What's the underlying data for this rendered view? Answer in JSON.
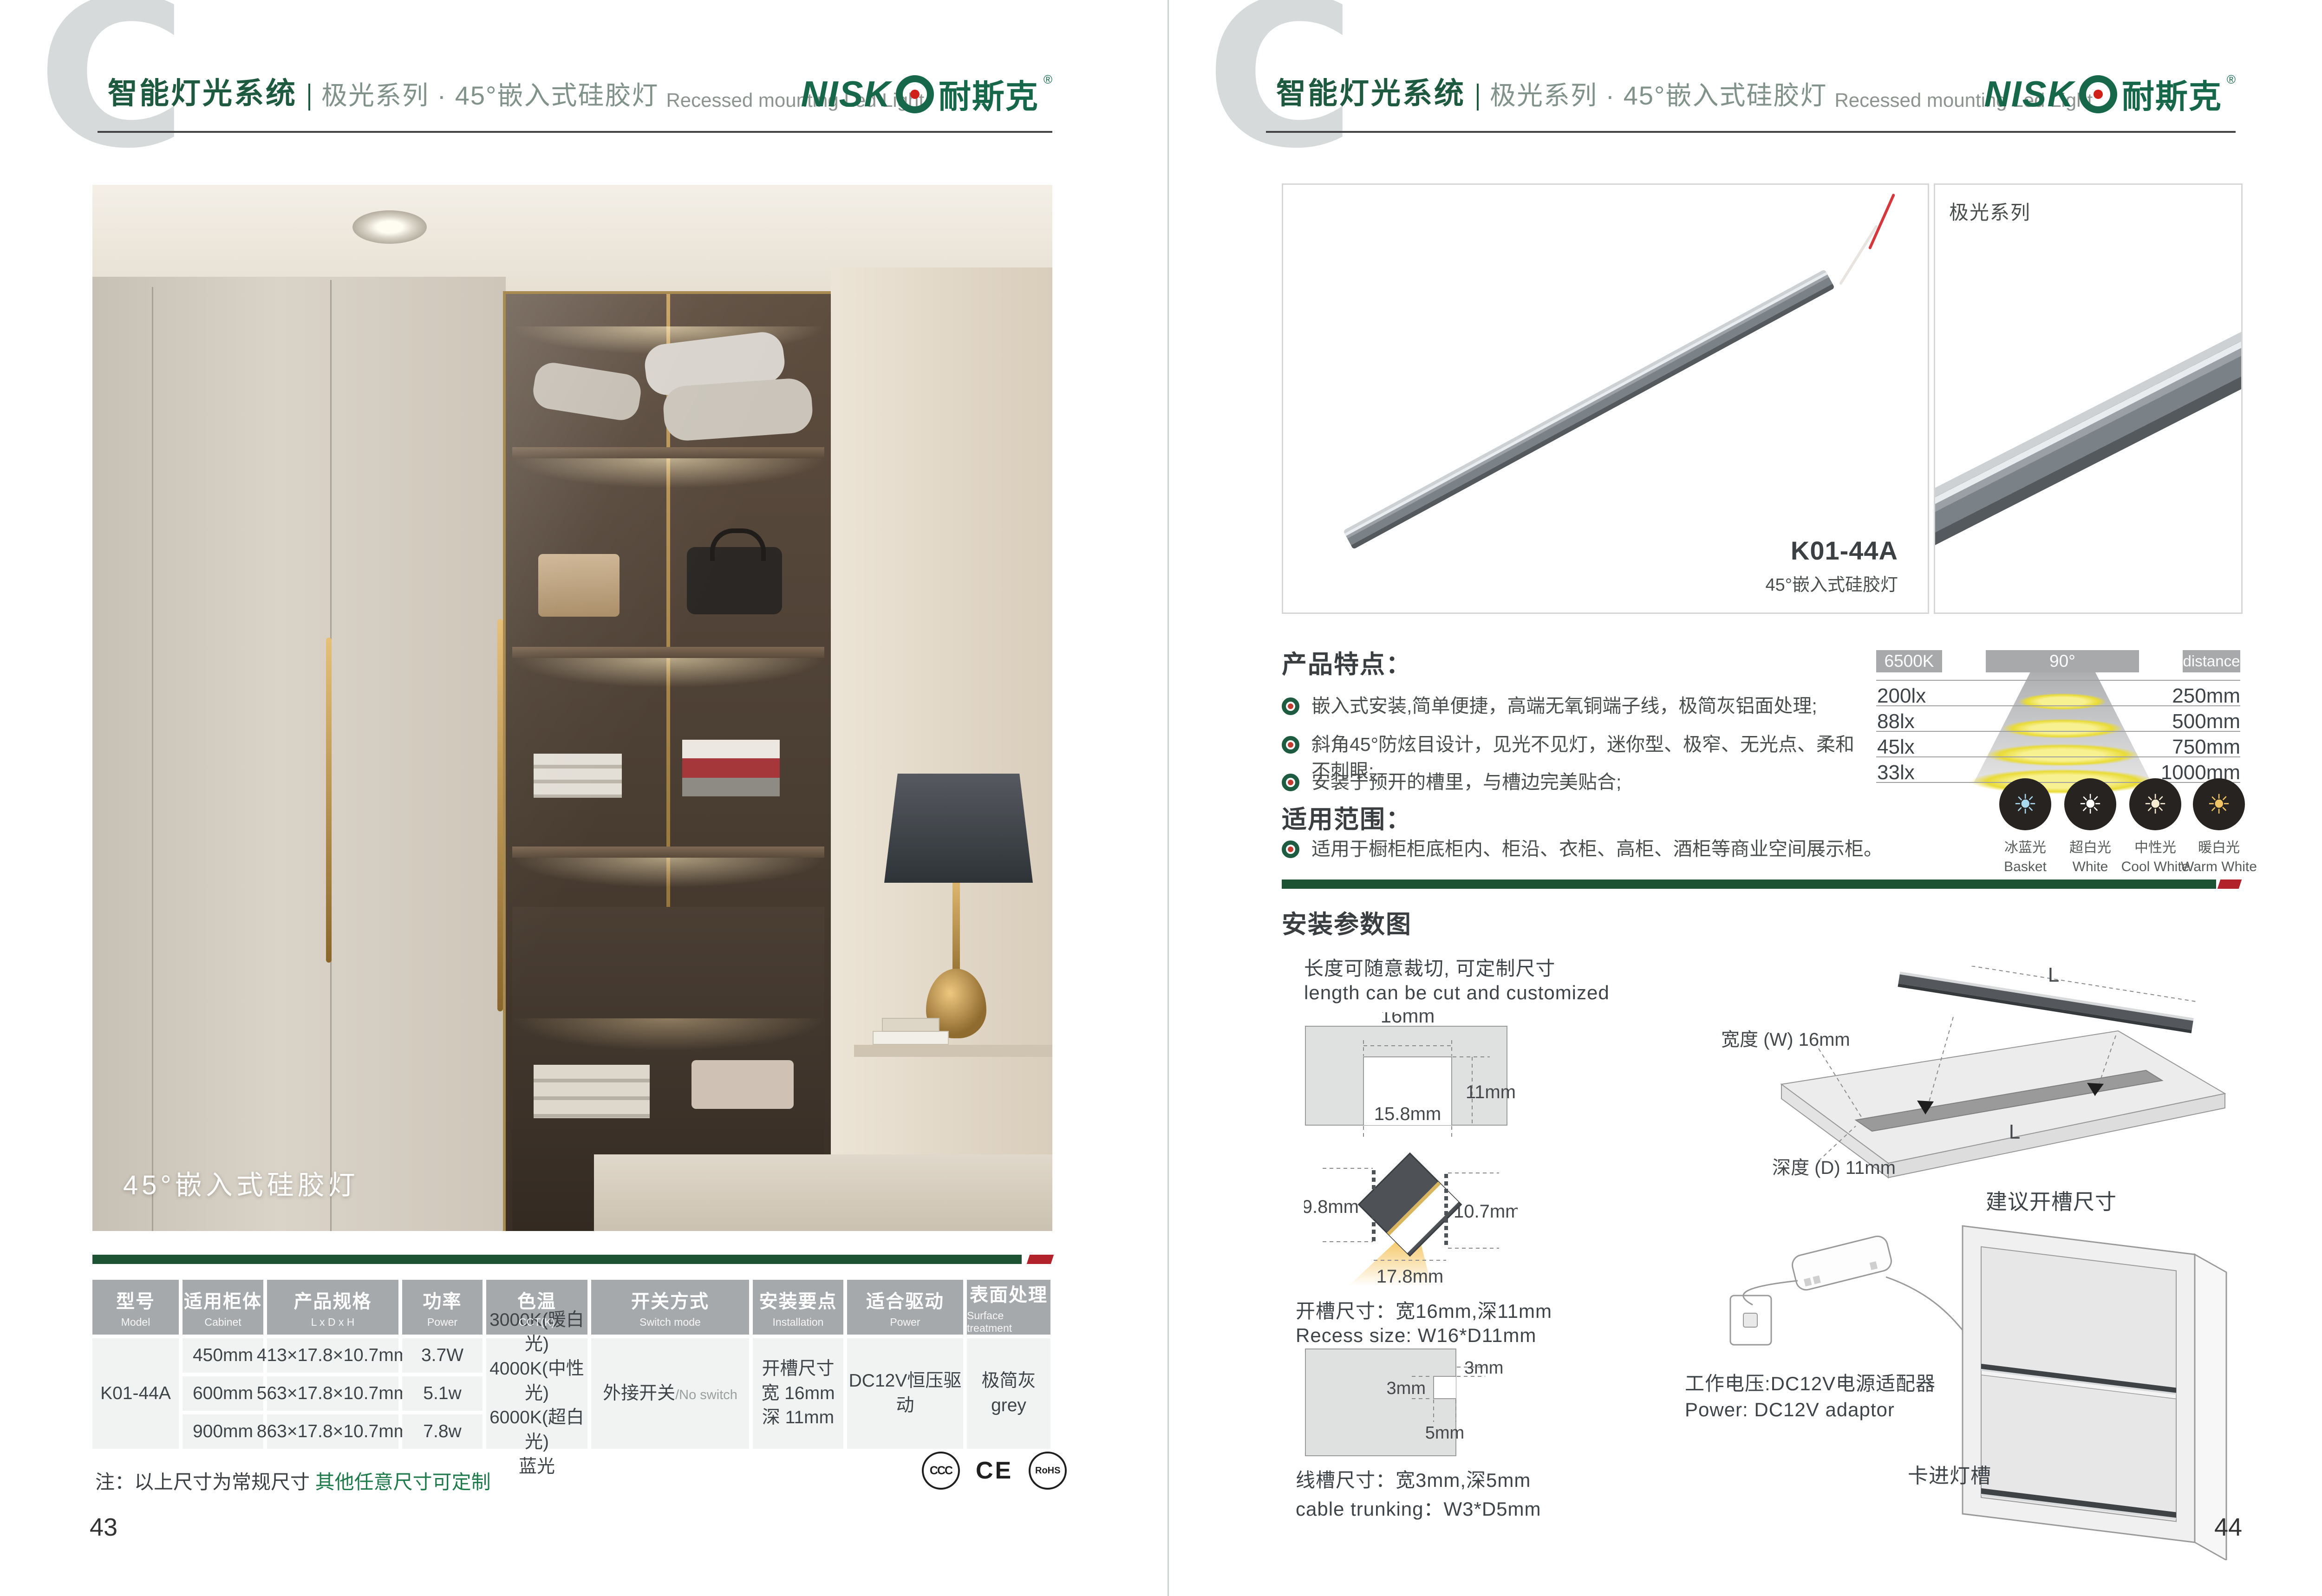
{
  "header": {
    "watermark": "C",
    "system_cn": "智能灯光系统",
    "series_cn": "极光系列 · 45°嵌入式硅胶灯",
    "series_en": "Recessed mounting Led Light",
    "brand_latin": "NISK",
    "brand_cn": "耐斯克",
    "brand_reg": "®"
  },
  "colors": {
    "brand_green": "#17684a",
    "bar_green": "#1d5233",
    "bar_red": "#b2222a",
    "table_header_gray": "#a6a9ab"
  },
  "left": {
    "photo_caption": "45°嵌入式硅胶灯",
    "table": {
      "headers": [
        {
          "cn": "型号",
          "en": "Model"
        },
        {
          "cn": "适用柜体",
          "en": "Cabinet"
        },
        {
          "cn": "产品规格",
          "en": "L x D x H"
        },
        {
          "cn": "功率",
          "en": "Power"
        },
        {
          "cn": "色温",
          "en": "CCT(K)"
        },
        {
          "cn": "开关方式",
          "en": "Switch mode"
        },
        {
          "cn": "安装要点",
          "en": "Installation"
        },
        {
          "cn": "适合驱动",
          "en": "Power"
        },
        {
          "cn": "表面处理",
          "en": "Surface treatment"
        }
      ],
      "model": "K01-44A",
      "size_rows": [
        {
          "cabinet": "450mm",
          "spec": "413×17.8×10.7mm",
          "power": "3.7W"
        },
        {
          "cabinet": "600mm",
          "spec": "563×17.8×10.7mm",
          "power": "5.1w"
        },
        {
          "cabinet": "900mm",
          "spec": "863×17.8×10.7mm",
          "power": "7.8w"
        }
      ],
      "cct_lines": [
        "3000K(暖白光)",
        "4000K(中性光)",
        "6000K(超白光)",
        "蓝光"
      ],
      "switch_cn": "外接开关",
      "switch_en": "/No switch",
      "install_lines": [
        "开槽尺寸",
        "宽 16mm",
        "深 11mm"
      ],
      "driver": "DC12V恒压驱动",
      "surface_lines": [
        "极简灰",
        "grey"
      ]
    },
    "note_prefix": "注：以上尺寸为常规尺寸 ",
    "note_green": "其他任意尺寸可定制",
    "certs": [
      "CCC",
      "CE",
      "RoHS"
    ],
    "page_number": "43"
  },
  "right": {
    "product_box": {
      "model": "K01-44A",
      "model_sub": "45°嵌入式硅胶灯"
    },
    "series_box_label": "极光系列",
    "features": {
      "title": "产品特点：",
      "items": [
        "嵌入式安装,简单便捷，高端无氧铜端子线，极简灰铝面处理;",
        "斜角45°防炫目设计，见光不见灯，迷你型、极窄、无光点、柔和不刺眼;",
        "安装于预开的槽里，与槽边完美贴合;"
      ]
    },
    "scope": {
      "title": "适用范围：",
      "items": [
        "适用于橱柜柜底柜内、柜沿、衣柜、高柜、酒柜等商业空间展示柜。"
      ]
    },
    "lux_chart": {
      "cct": "6500K",
      "angle": "90°",
      "distance_label": "distance",
      "rows": [
        {
          "lux": "200lx",
          "dist": "250mm"
        },
        {
          "lux": "88lx",
          "dist": "500mm"
        },
        {
          "lux": "45lx",
          "dist": "750mm"
        },
        {
          "lux": "33lx",
          "dist": "1000mm"
        }
      ],
      "colors": [
        {
          "cn": "冰蓝光",
          "en": "Basket",
          "hex": "#a9d9ef"
        },
        {
          "cn": "超白光",
          "en": "White",
          "hex": "#ffffff"
        },
        {
          "cn": "中性光",
          "en": "Cool White",
          "hex": "#f6ecd2"
        },
        {
          "cn": "暖白光",
          "en": "Warm White",
          "hex": "#f2c465"
        }
      ]
    },
    "install": {
      "title": "安装参数图",
      "cut_note_cn": "长度可随意裁切, 可定制尺寸",
      "cut_note_en": "length can be cut and customized",
      "recess": {
        "top": "16mm",
        "depth": "11mm",
        "inner": "15.8mm"
      },
      "profile": {
        "left": "9.8mm",
        "right": "10.7mm",
        "bottom": "17.8mm"
      },
      "recess_text_cn": "开槽尺寸：宽16mm,深11mm",
      "recess_text_en": "Recess size: W16*D11mm",
      "trunking": {
        "right": "3mm",
        "left": "3mm",
        "bottom": "5mm"
      },
      "trunking_text_cn": "线槽尺寸：宽3mm,深5mm",
      "trunking_text_en": "cable trunking：W3*D5mm",
      "board": {
        "l_top": "L",
        "l_bottom": "L",
        "width_label": "宽度 (W) 16mm",
        "depth_label": "深度 (D) 11mm",
        "caption": "建议开槽尺寸"
      },
      "power_cn": "工作电压:DC12V电源适配器",
      "power_en": "Power: DC12V adaptor",
      "clip_label": "卡进灯槽"
    },
    "page_number": "44"
  },
  "chart_data": {
    "type": "table",
    "title": "Illuminance vs distance (6500K, 90° beam)",
    "columns": [
      "illuminance",
      "distance"
    ],
    "rows": [
      [
        "200lx",
        "250mm"
      ],
      [
        "88lx",
        "500mm"
      ],
      [
        "45lx",
        "750mm"
      ],
      [
        "33lx",
        "1000mm"
      ]
    ],
    "cct": "6500K",
    "beam_angle": "90°"
  }
}
